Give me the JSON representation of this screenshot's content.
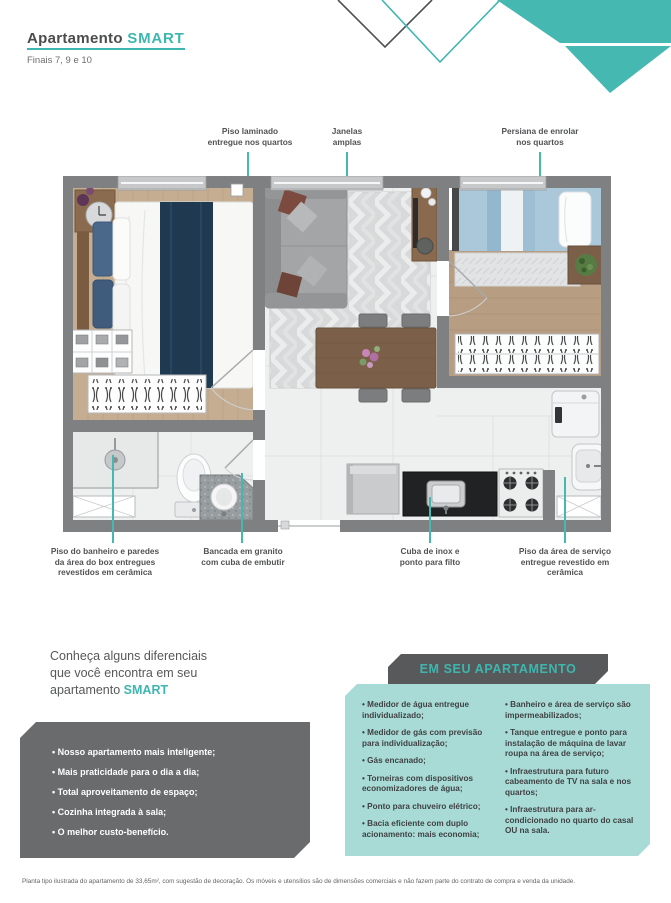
{
  "header": {
    "title": "Apartamento",
    "title_accent": "SMART",
    "subtitle": "Finais 7, 9 e 10"
  },
  "colors": {
    "accent_teal": "#3eb6b0",
    "light_teal_box": "#a9dbd6",
    "dark_gray_box": "#6a6b6d",
    "header_bar": "#58595b",
    "wall_gray": "#7e8082"
  },
  "floorplan_callouts": {
    "top": [
      {
        "lines": [
          "Piso laminado",
          "entregue nos quartos"
        ]
      },
      {
        "lines": [
          "Janelas",
          "amplas"
        ]
      },
      {
        "lines": [
          "Persiana de enrolar",
          "nos quartos"
        ]
      }
    ],
    "bottom": [
      {
        "lines": [
          "Piso do banheiro e paredes",
          "da área do box entregues",
          "revestidos em cerâmica"
        ]
      },
      {
        "lines": [
          "Bancada em granito",
          "com cuba de embutir"
        ]
      },
      {
        "lines": [
          "Cuba de inox e",
          "ponto para filto"
        ]
      },
      {
        "lines": [
          "Piso da área de serviço",
          "entregue revestido em",
          "cerâmica"
        ]
      }
    ]
  },
  "diferenciais": {
    "intro_line1": "Conheça alguns diferenciais",
    "intro_line2": "que você encontra em seu",
    "intro_line3": "apartamento",
    "intro_accent": "SMART",
    "items": [
      "Nosso apartamento mais inteligente;",
      "Mais praticidade para o dia a dia;",
      "Total aproveitamento de espaço;",
      "Cozinha integrada à sala;",
      "O melhor custo-benefício."
    ]
  },
  "em_seu_apartamento": {
    "title": "EM SEU APARTAMENTO",
    "col1": [
      "Medidor de água entregue individualizado;",
      "Medidor de gás com previsão para individualização;",
      "Gás encanado;",
      "Torneiras com dispositivos economizadores de água;",
      "Ponto para chuveiro elétrico;",
      "Bacia eficiente com duplo acionamento: mais economia;"
    ],
    "col2": [
      "Banheiro e área de serviço são impermeabilizados;",
      "Tanque entregue e ponto para instalação de máquina de lavar roupa na área de serviço;",
      "Infraestrutura para futuro cabeamento de TV na sala e nos quartos;",
      "Infraestrutura para ar-condicionado no quarto do casal OU na sala."
    ]
  },
  "footer": {
    "disclaimer": "Planta tipo ilustrada do apartamento de 33,65m², com sugestão de decoração. Os móveis e utensílios são de dimensões comerciais e não fazem parte do contrato de compra e venda da unidade."
  }
}
